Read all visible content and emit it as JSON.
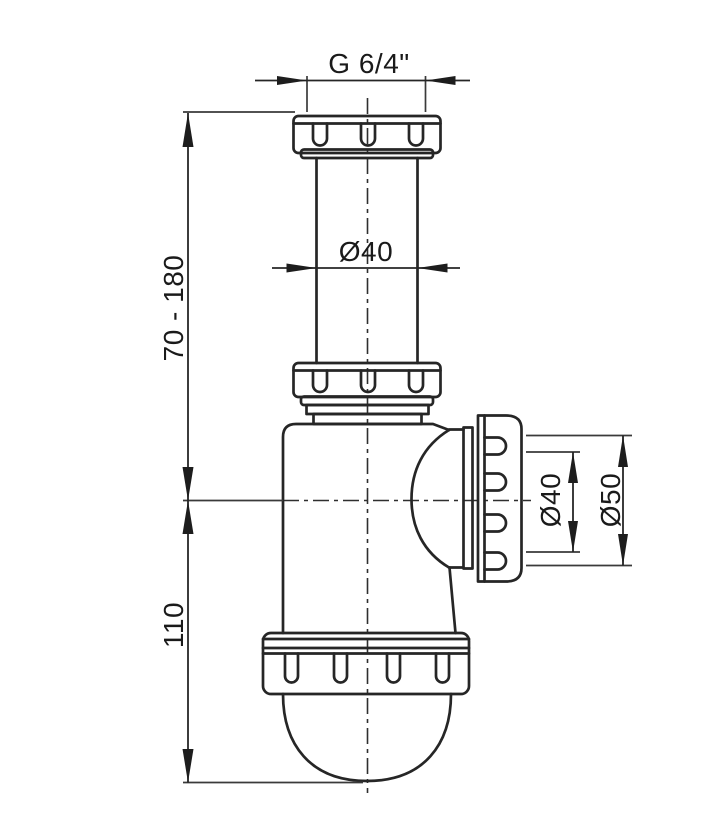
{
  "drawing": {
    "kind": "bottle-trap-siphon-technical-drawing",
    "colors": {
      "background": "#ffffff",
      "line": "#262626",
      "text": "#1a1a1a"
    },
    "labels": {
      "thread_size": "G 6/4\"",
      "inlet_pipe_diameter": "Ø40",
      "adjustable_inlet_height": "70 - 180",
      "body_height": "110",
      "outlet_inner_diameter": "Ø40",
      "outlet_outer_diameter": "Ø50"
    }
  }
}
